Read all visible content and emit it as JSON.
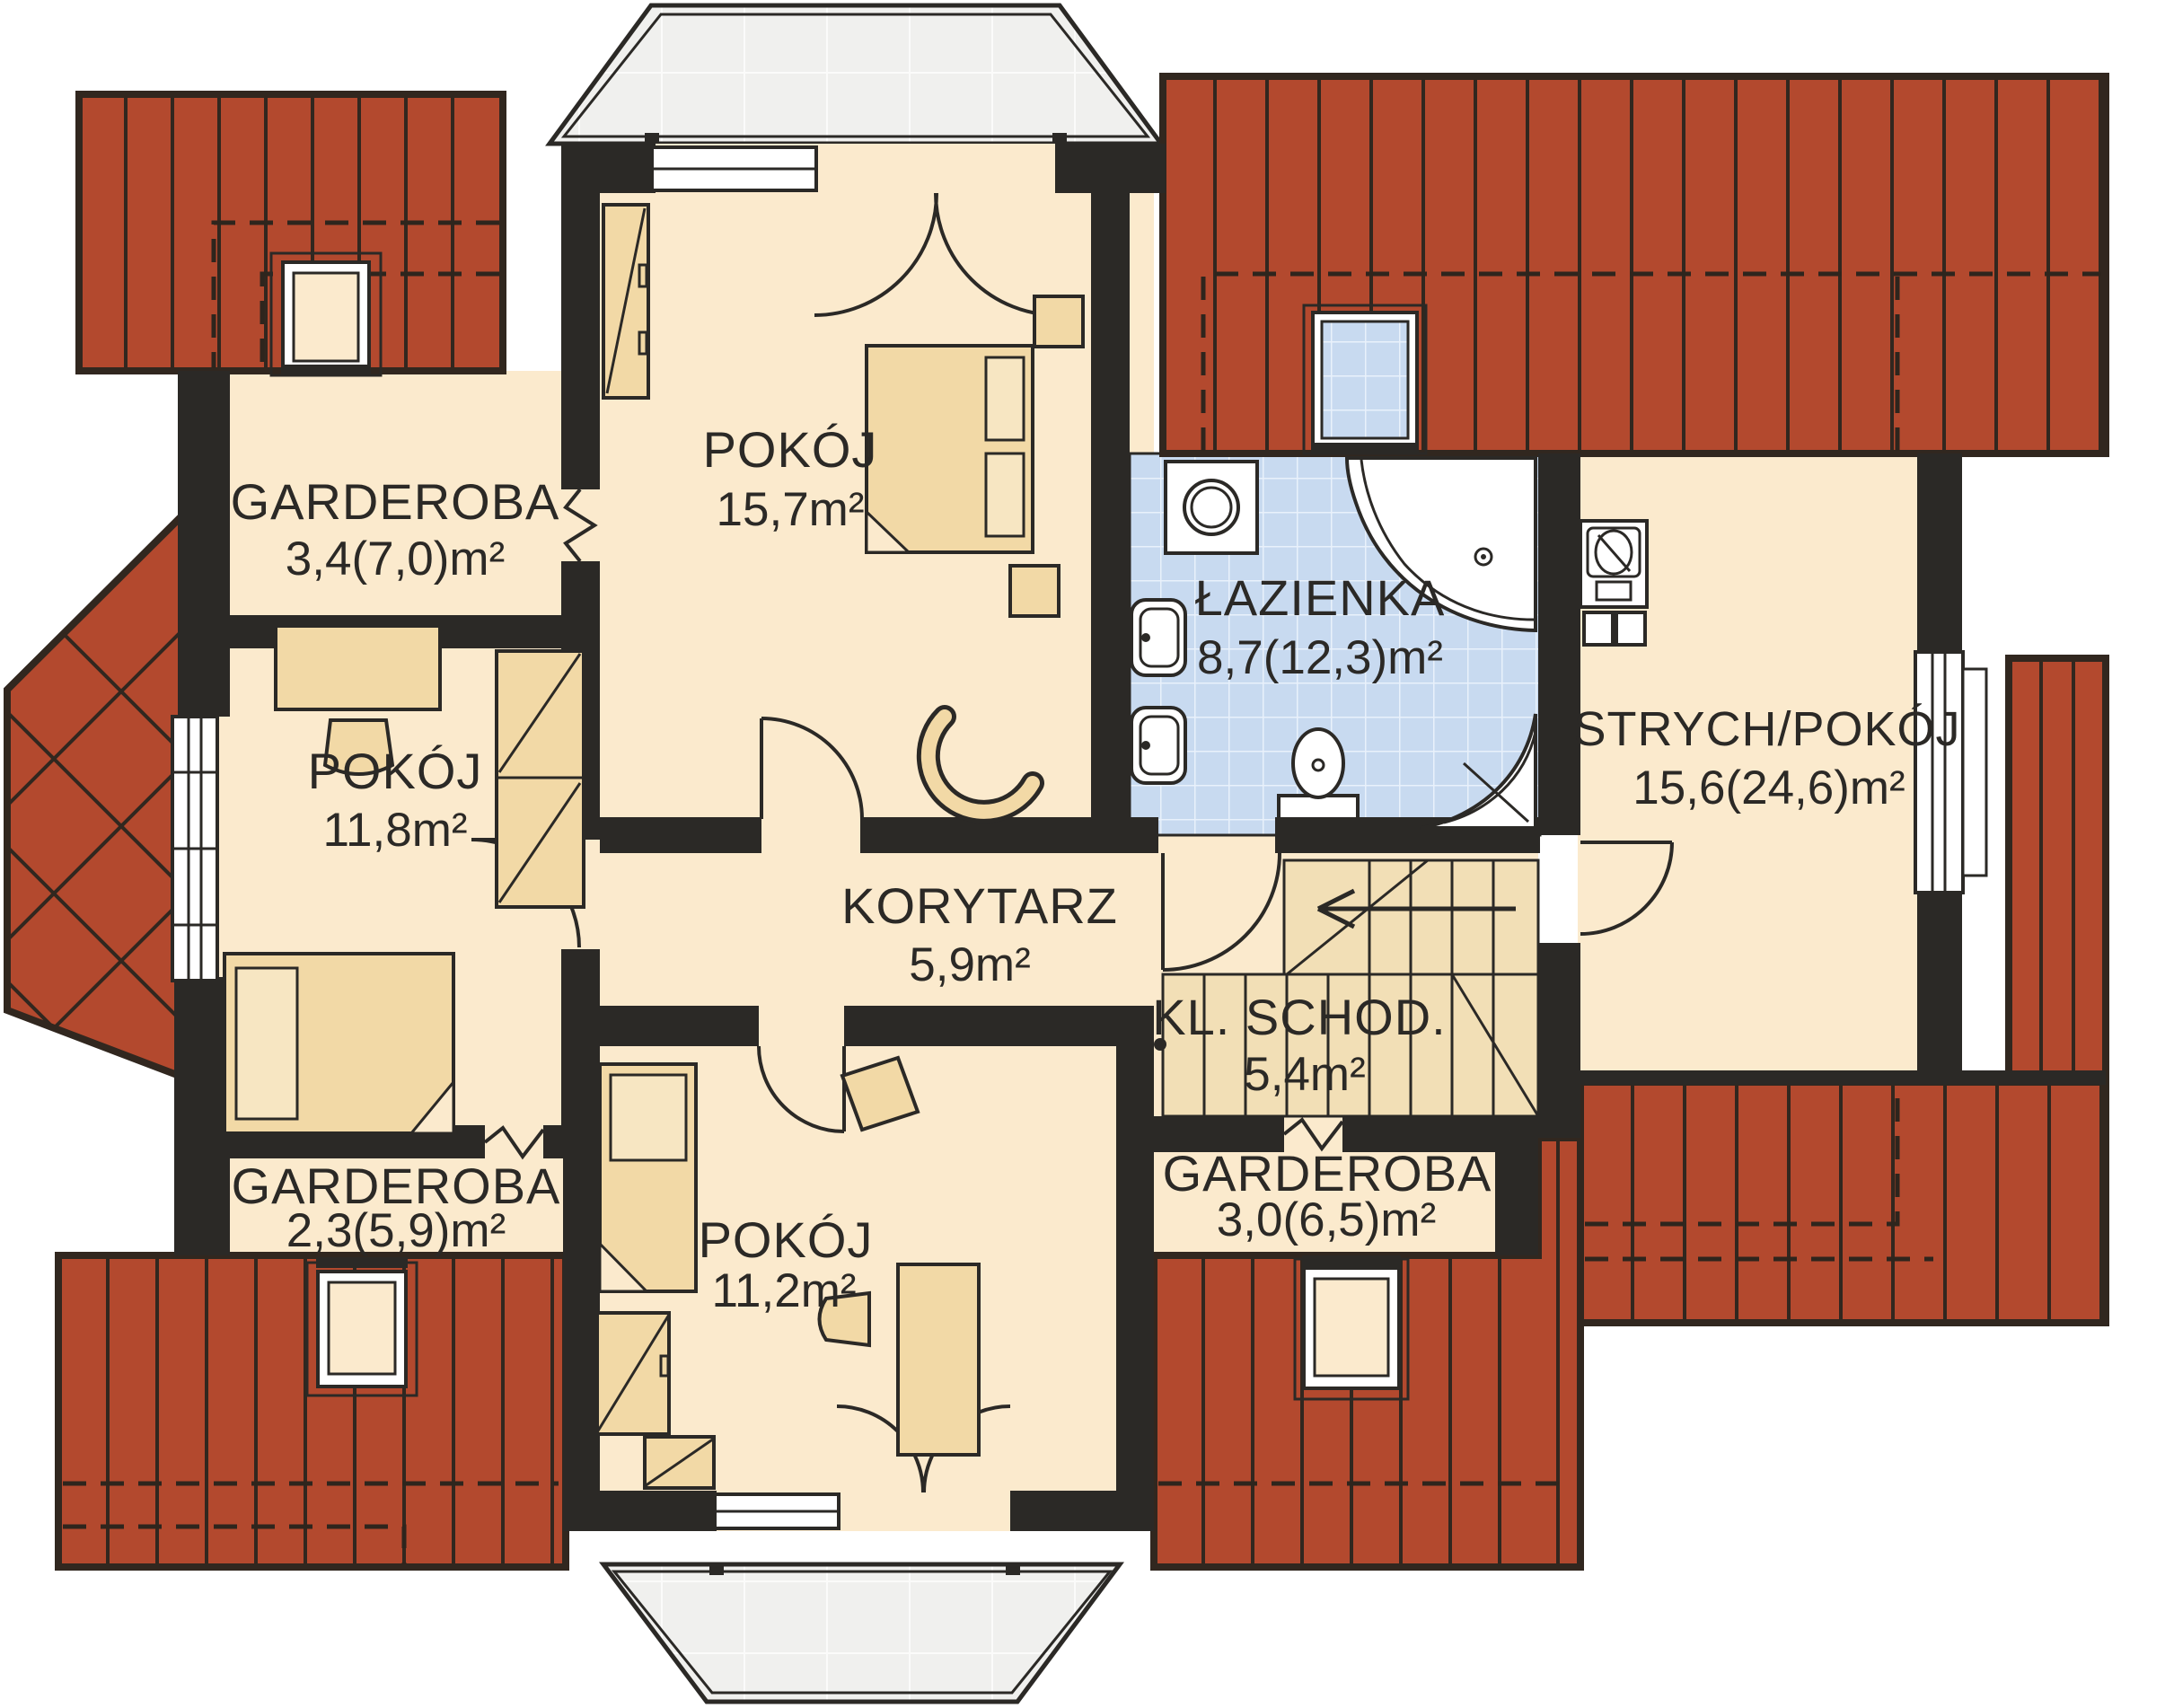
{
  "rooms": [
    {
      "id": "garderoba-tl",
      "name": "GARDEROBA",
      "area": "3,4(7,0)m²"
    },
    {
      "id": "pokoj-157",
      "name": "POKÓJ",
      "area": "15,7m²"
    },
    {
      "id": "lazienka",
      "name": "ŁAZIENKA",
      "area": "8,7(12,3)m²"
    },
    {
      "id": "strych-pokoj",
      "name": "STRYCH/POKÓJ",
      "area": "15,6(24,6)m²"
    },
    {
      "id": "pokoj-118",
      "name": "POKÓJ",
      "area": "11,8m²"
    },
    {
      "id": "korytarz",
      "name": "KORYTARZ",
      "area": "5,9m²"
    },
    {
      "id": "kl-schod",
      "name": "KL. SCHOD.",
      "area": "5,4m²"
    },
    {
      "id": "garderoba-bl",
      "name": "GARDEROBA",
      "area": "2,3(5,9)m²"
    },
    {
      "id": "pokoj-112",
      "name": "POKÓJ",
      "area": "11,2m²"
    },
    {
      "id": "garderoba-br",
      "name": "GARDEROBA",
      "area": "3,0(6,5)m²"
    }
  ],
  "symbols": [
    "roof",
    "roof-window",
    "bathroom-skylight",
    "bay-roof",
    "balcony",
    "double-bed",
    "single-bed",
    "wardrobe",
    "desk",
    "chair",
    "armchair",
    "washing-machine",
    "corner-bathtub",
    "sink",
    "toilet",
    "shower",
    "staircase",
    "stairs-direction-arrow",
    "ventilation-unit",
    "door-swing",
    "window",
    "folding-door"
  ],
  "colors": {
    "roof": "#B3492E",
    "wall": "#2B2926",
    "floor": "#FBEACD",
    "furniture": "#F2D9A6",
    "bathroom_tile": "#C8DAF0",
    "balcony": "#F0F0EE",
    "text": "#2B2926",
    "background": "#FFFFFF"
  }
}
